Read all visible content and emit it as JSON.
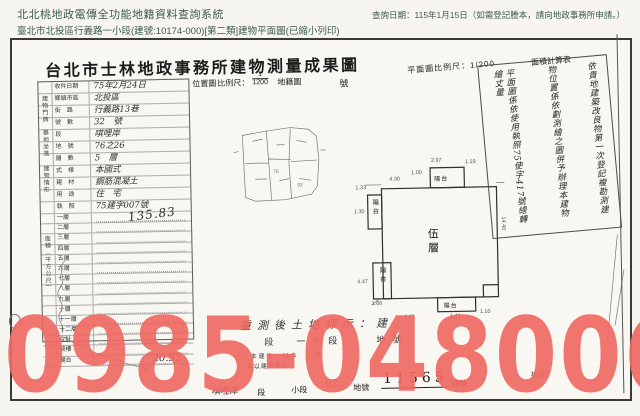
{
  "header": {
    "system_title": "北北桃地政電傳全功能地籍資料查詢系統",
    "query_date": "查詢日期：115年1月15日（如需登記謄本，請向地政事務所申請。）",
    "subtitle": "臺北市北投區行義路一小段(建號:10174-000)[第二類]建物平面圖(已縮小列印)"
  },
  "document": {
    "title": "台北市士林地政事務所建物測量成果圖",
    "scale_row": {
      "location_map": "位置圖",
      "scale_label": "比例尺：",
      "scale_num": "1",
      "scale_den": "1200",
      "cadastre_map": "地籍圖",
      "number": "號",
      "plan_scale": "平面圖比例尺：1/200",
      "area_calc": "面積計算表"
    },
    "info_rows": [
      {
        "label": "收件日期",
        "value": "75年2月24日"
      },
      {
        "label": "鄉鎮市區",
        "value": "北投區"
      },
      {
        "label": "街　路",
        "value": "行義路13巷"
      },
      {
        "label": "號　數",
        "value": "32　號"
      },
      {
        "label": "段",
        "value": "唭哩岸"
      },
      {
        "label": "地　號",
        "value": "76之26"
      },
      {
        "label": "層　數",
        "value": "5　層"
      },
      {
        "label": "式　樣",
        "value": "本國式"
      },
      {
        "label": "建　材",
        "value": "鋼筋混凝土"
      },
      {
        "label": "用　途",
        "value": "住　宅"
      },
      {
        "label": "執　照",
        "value": "75建字007號"
      }
    ],
    "side_labels": [
      "建物門牌",
      "基地坐落",
      "建物情形",
      "面積（平方公尺）"
    ],
    "area_table": {
      "rows": [
        "一層",
        "二層",
        "三層",
        "四層",
        "五層",
        "六層",
        "七層",
        "八層",
        "九層",
        "十層",
        "十一層",
        "十二層",
        "合計",
        "騎樓",
        "陽台"
      ],
      "values": {
        "wuceng": "135.83",
        "yangtai": "20.92"
      }
    },
    "sketch": {
      "labels": [
        "76",
        "92"
      ]
    },
    "plan": {
      "floor_label": "伍層",
      "balcony_top": "陽台",
      "balcony_left_a": "陽台",
      "balcony_left_b": "陽台",
      "balcony_bottom": "陽台",
      "dims": [
        "2.97",
        "1.19",
        "1.00",
        "4.30",
        "1.33",
        "1.30",
        "14.40",
        "4.47",
        "1.66",
        "4.40",
        "1.46",
        "1.10"
      ]
    },
    "notes_vertical": {
      "col1": "依貴地建築改良物第一次登記複勘測建",
      "col2": "物位置係依劃測繪之圖併予辦理本建物",
      "col3": "平面圖係依使用執照75使字417號總轉繪丈量"
    },
    "bottom_notes": {
      "line1": "重測後土地標示：建",
      "line2": "段　一小段　　地號",
      "line3": "一、本建物　以本　　測",
      "line4": "本以建物登記"
    },
    "bottom_row": {
      "section_hand": "唭哩岸",
      "section": "段",
      "subsection": "小段",
      "parcel_hand": "92",
      "parcel": "地號",
      "building_no": "11565",
      "building": "建號",
      "issue": "核發"
    },
    "watermark": {
      "text": "0985-048006",
      "color": "#ef6a63"
    }
  }
}
